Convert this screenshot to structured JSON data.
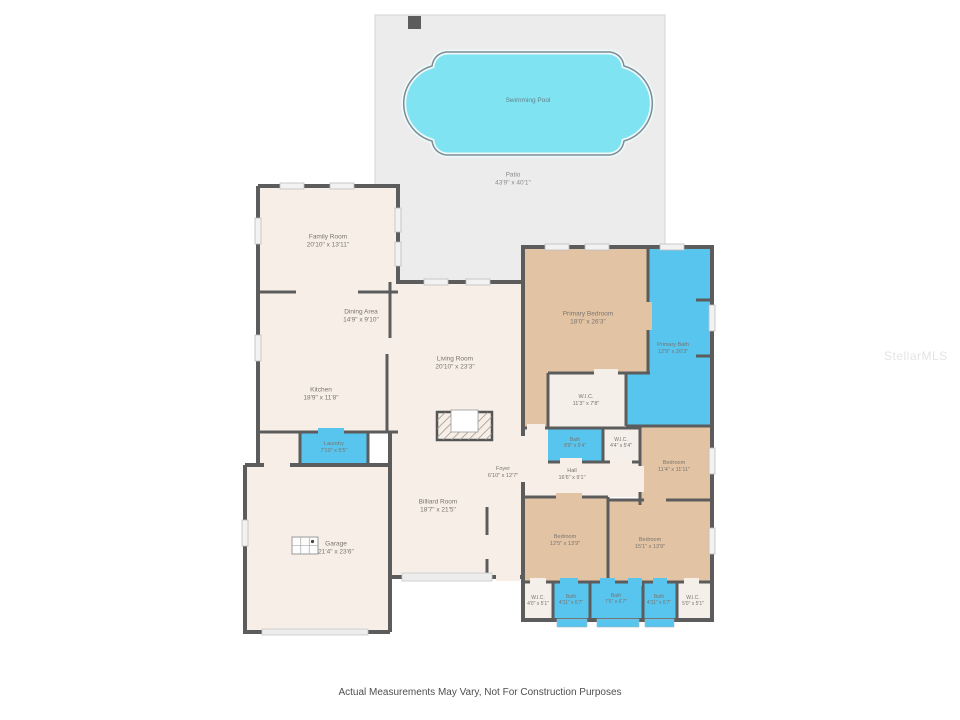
{
  "watermark": "StellarMLS",
  "disclaimer": "Actual Measurements May Vary, Not For Construction Purposes",
  "colors": {
    "wall": "#5c5c5c",
    "floor_cream": "#f7efe7",
    "closet_cream": "#f4efe8",
    "bedroom_tan": "#e2c4a4",
    "water_blue": "#58c5ef",
    "pool_cyan": "#7fe3f2",
    "patio_gray": "#ececec"
  },
  "rooms": {
    "swimming_pool": {
      "name": "Swimming Pool",
      "dims": ""
    },
    "patio": {
      "name": "Patio",
      "dims": "43'9\" x 40'1\""
    },
    "family_room": {
      "name": "Family Room",
      "dims": "20'10\" x 13'11\""
    },
    "dining_area": {
      "name": "Dining Area",
      "dims": "14'9\" x 9'10\""
    },
    "kitchen": {
      "name": "Kitchen",
      "dims": "18'9\" x 11'8\""
    },
    "living_room": {
      "name": "Living Room",
      "dims": "20'10\" x 23'3\""
    },
    "laundry": {
      "name": "Laundry",
      "dims": "7'10\" x 5'5\""
    },
    "garage": {
      "name": "Garage",
      "dims": "21'4\" x 23'6\""
    },
    "billiard_room": {
      "name": "Billiard Room",
      "dims": "18'7\" x 21'5\""
    },
    "foyer": {
      "name": "Foyer",
      "dims": "6'10\" x 12'7\""
    },
    "hall": {
      "name": "Hall",
      "dims": "16'6\" x 9'1\""
    },
    "primary_bedroom": {
      "name": "Primary Bedroom",
      "dims": "18'0\" x 26'3\""
    },
    "primary_bath": {
      "name": "Primary Bath",
      "dims": "12'9\" x 26'3\""
    },
    "wic_primary": {
      "name": "W.I.C.",
      "dims": "11'3\" x 7'8\""
    },
    "bath_hall": {
      "name": "Bath",
      "dims": "8'9\" x 5'4\""
    },
    "wic_hall": {
      "name": "W.I.C.",
      "dims": "4'4\" x 5'4\""
    },
    "bedroom_right": {
      "name": "Bedroom",
      "dims": "11'4\" x 11'11\""
    },
    "bedroom_left": {
      "name": "Bedroom",
      "dims": "12'5\" x 13'9\""
    },
    "bedroom_center": {
      "name": "Bedroom",
      "dims": "15'1\" x 13'9\""
    },
    "wic_bottom_left": {
      "name": "W.I.C.",
      "dims": "4'0\" x 5'1\""
    },
    "bath_bottom_left": {
      "name": "Bath",
      "dims": "4'11\" x 6'7\""
    },
    "bath_bottom_center": {
      "name": "Bath",
      "dims": "7'6\" x 6'7\""
    },
    "bath_bottom_right": {
      "name": "Bath",
      "dims": "4'11\" x 6'7\""
    },
    "wic_bottom_right": {
      "name": "W.I.C.",
      "dims": "5'0\" x 5'1\""
    }
  }
}
